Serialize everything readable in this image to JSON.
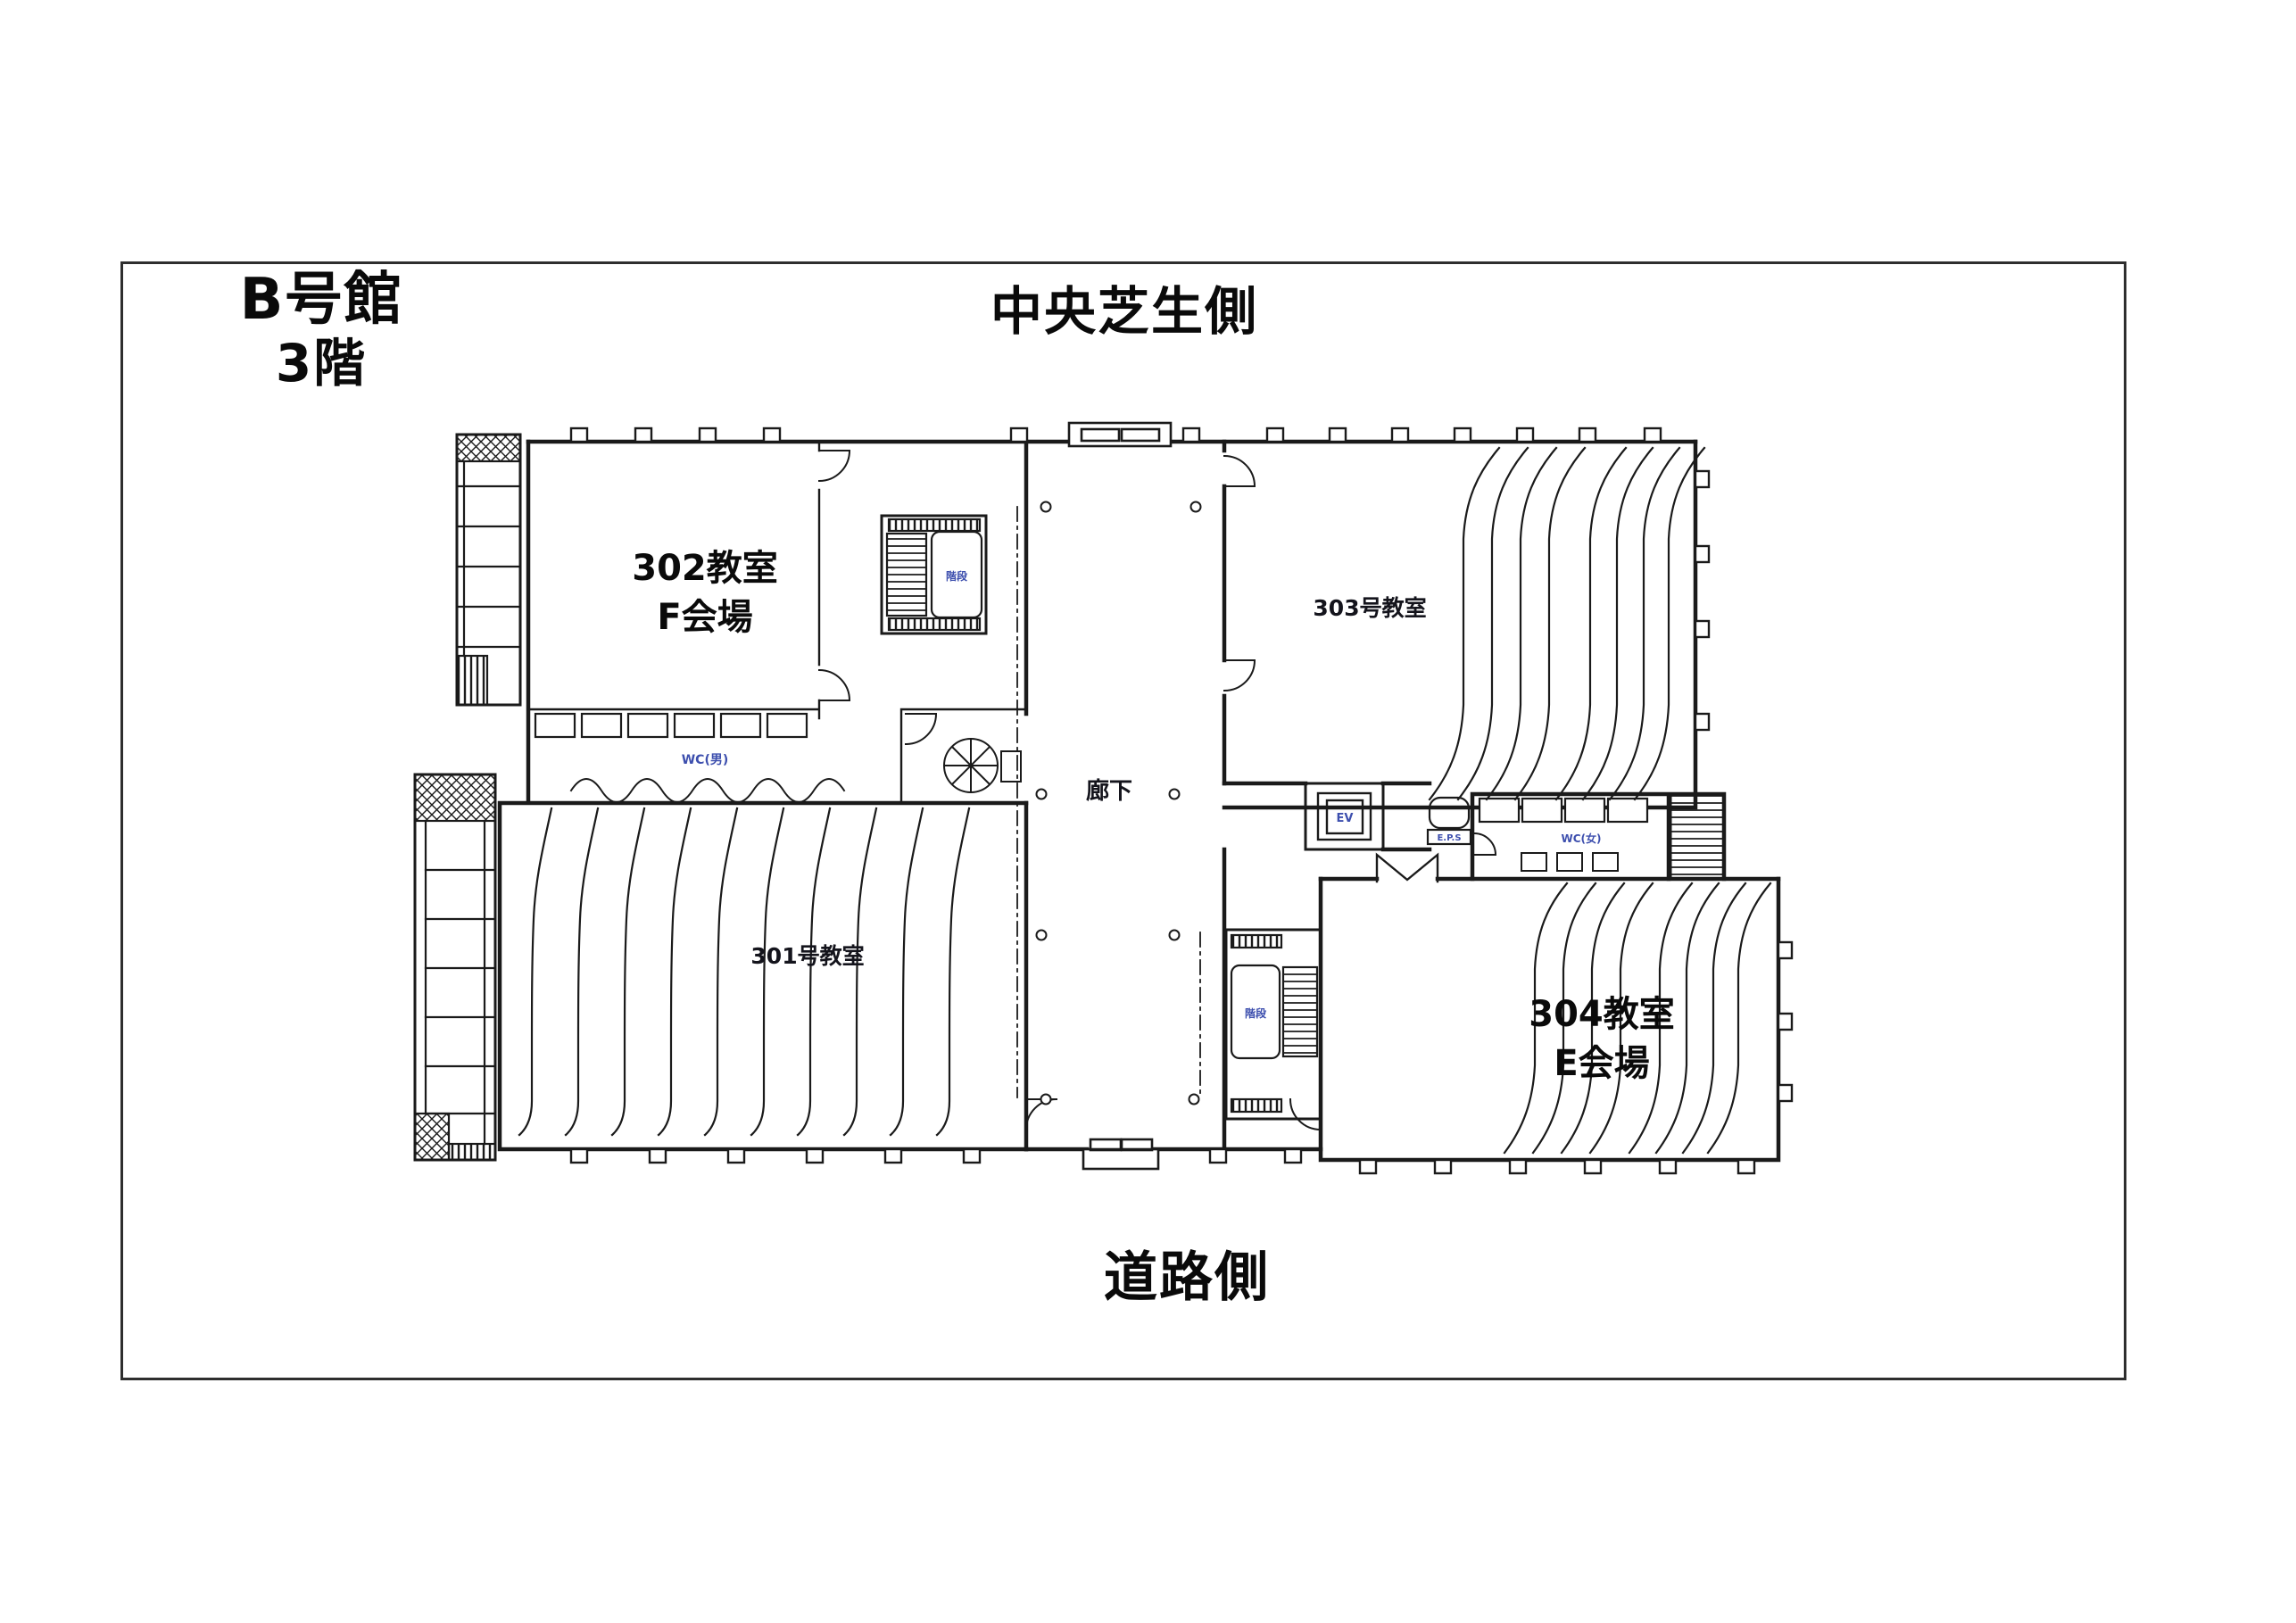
{
  "page": {
    "building": {
      "line1": "B号館",
      "line2": "3階"
    },
    "orientation": {
      "top": "中央芝生側",
      "bottom": "道路側"
    }
  },
  "floorplan": {
    "rooms": {
      "room302": {
        "line1": "302教室",
        "line2": "F会場"
      },
      "room303": {
        "label": "303号教室"
      },
      "room301": {
        "label": "301号教室"
      },
      "room304": {
        "line1": "304教室",
        "line2": "E会場"
      }
    },
    "labels": {
      "corridor": "廊下",
      "stairs_upper": "階段",
      "stairs_lower": "階段",
      "elevator": "EV",
      "eps": "E.P.S",
      "wc_left": "WC(男)",
      "wc_right": "WC(女)"
    },
    "colors": {
      "ink": "#1a1a1a",
      "utility_label": "#3d4fae"
    }
  }
}
